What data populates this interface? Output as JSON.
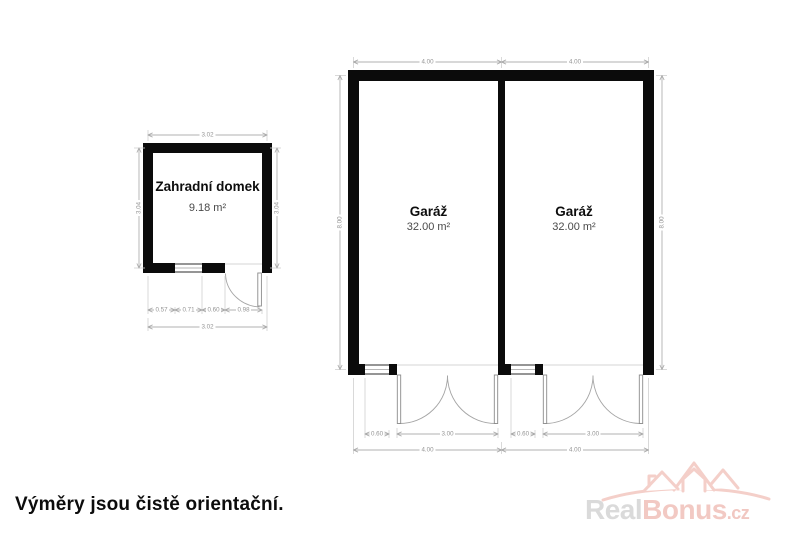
{
  "garden_house": {
    "label": "Zahradní domek",
    "area": "9.18 m²",
    "dim_top": "3.02",
    "dim_left": "3.04",
    "dim_right": "3.04",
    "dim_bottom_total": "3.02",
    "dim_segments": [
      "0.57",
      "0.71",
      "0.60",
      "0.98"
    ]
  },
  "garage": {
    "left_room": {
      "label": "Garáž",
      "area": "32.00 m²"
    },
    "right_room": {
      "label": "Garáž",
      "area": "32.00 m²"
    },
    "dim_top": [
      "4.00",
      "4.00"
    ],
    "dim_left": "8.00",
    "dim_right": "8.00",
    "left_bottom": {
      "window": "0.60",
      "door": "3.00",
      "total": "4.00"
    },
    "right_bottom": {
      "window": "0.60",
      "door": "3.00",
      "total": "4.00"
    }
  },
  "footer": {
    "note": "Výměry jsou čistě orientační."
  },
  "logo": {
    "part1": "Real",
    "part2": "Bonus",
    "part3": ".cz"
  },
  "colors": {
    "wall": "#0b0b0b",
    "dimension": "#b0b0b0",
    "dimension_text": "#949494",
    "logo_gray": "#dadada",
    "logo_pink": "#f2c9c3"
  }
}
